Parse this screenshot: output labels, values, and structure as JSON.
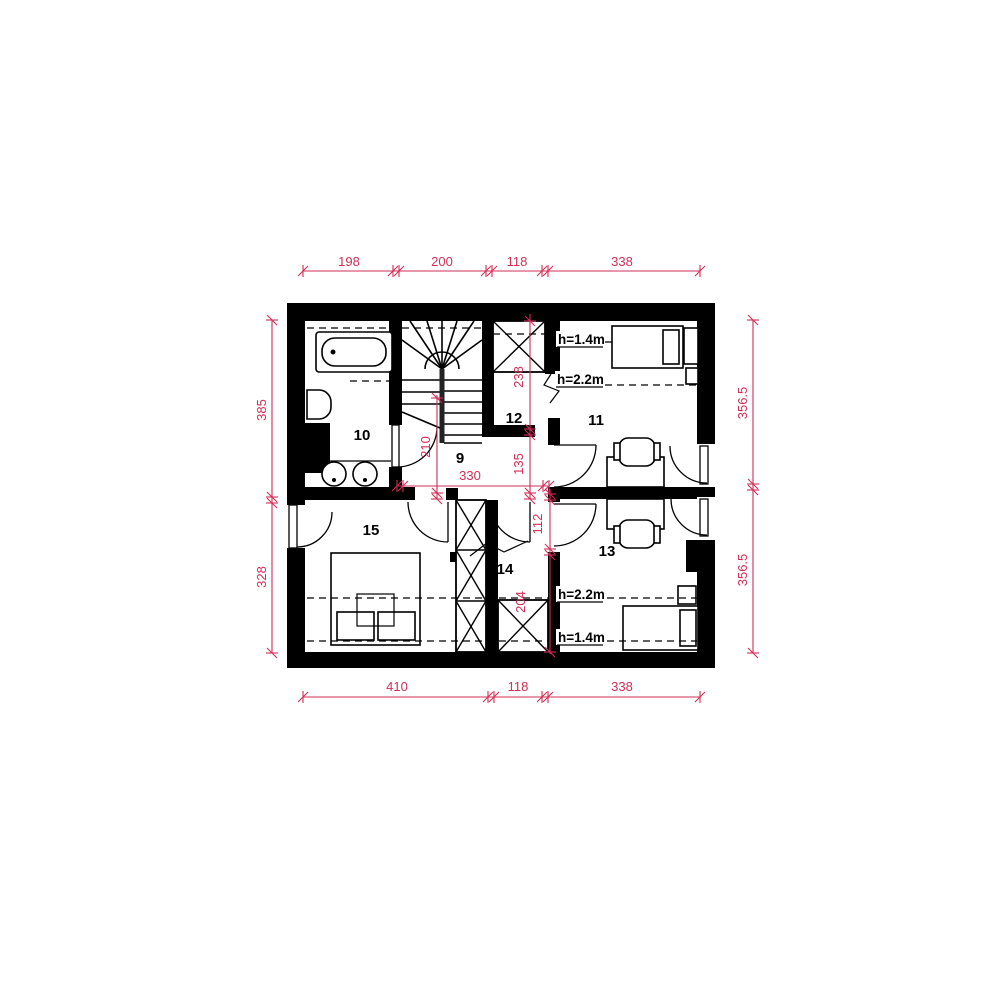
{
  "title": "attic floor plan",
  "colors": {
    "wall": "#000000",
    "dimension": "#d22e56",
    "background": "#ffffff"
  },
  "rooms": {
    "r9": "9",
    "r10": "10",
    "r11": "11",
    "r12": "12",
    "r13": "13",
    "r14": "14",
    "r15": "15"
  },
  "dims": {
    "top": [
      "198",
      "200",
      "118",
      "338"
    ],
    "bottom": [
      "410",
      "118",
      "338"
    ],
    "left": [
      "385",
      "328"
    ],
    "right": [
      "356.5",
      "356.5"
    ],
    "inner": {
      "v238": "238",
      "v135": "135",
      "v210": "210",
      "h330": "330",
      "v112": "112",
      "v204": "204"
    }
  },
  "heights": {
    "r11_low": "h=1.4m",
    "r11_high": "h=2.2m",
    "r13_high": "h=2.2m",
    "r13_low": "h=1.4m"
  }
}
